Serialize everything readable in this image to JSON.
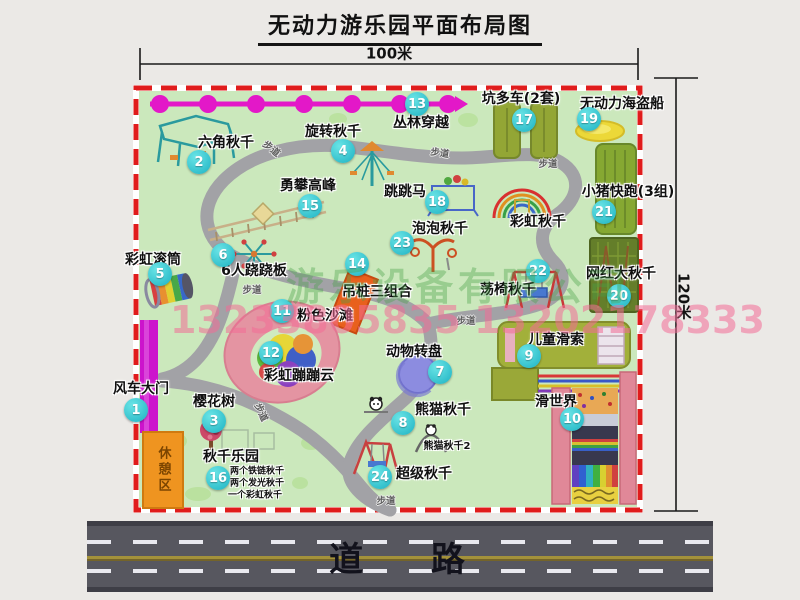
{
  "title": "无动力游乐园平面布局图",
  "dimensions": {
    "width_label": "100米",
    "height_label": "120米"
  },
  "road": {
    "label": "道 路"
  },
  "watermark": {
    "company": "游乐设备有限公司",
    "phone": "13233805835 13202178333"
  },
  "path_label": "步道",
  "colors": {
    "accent_badge": "#1db2c2",
    "border_red": "#e01c1c",
    "map_green": "#cbe8bc",
    "road_gray": "#57575f",
    "chain_magenta": "#e318c8",
    "rest_orange": "#ef9420"
  },
  "map": {
    "attractions": [
      {
        "num": "1",
        "name": "风车大门"
      },
      {
        "num": "2",
        "name": "六角秋千"
      },
      {
        "num": "3",
        "name": "樱花树"
      },
      {
        "num": "4",
        "name": "旋转秋千"
      },
      {
        "num": "5",
        "name": "彩虹滚筒"
      },
      {
        "num": "6",
        "name": "6人跷跷板"
      },
      {
        "num": "7",
        "name": "动物转盘"
      },
      {
        "num": "8",
        "name": "熊猫秋千"
      },
      {
        "num": "9",
        "name": "儿童滑索"
      },
      {
        "num": "10",
        "name": "滑世界"
      },
      {
        "num": "11",
        "name": "粉色沙滩"
      },
      {
        "num": "12",
        "name": "彩虹蹦蹦云"
      },
      {
        "num": "13",
        "name": "丛林穿越"
      },
      {
        "num": "14",
        "name": "吊桩三组合"
      },
      {
        "num": "15",
        "name": "勇攀高峰"
      },
      {
        "num": "16",
        "name": "秋千乐园"
      },
      {
        "num": "17",
        "name": "坑多车(2套)"
      },
      {
        "num": "18",
        "name": "跳跳马"
      },
      {
        "num": "19",
        "name": "无动力海盗船"
      },
      {
        "num": "20",
        "name": "网红大秋千"
      },
      {
        "num": "21",
        "name": "小猪快跑(3组)"
      },
      {
        "num": "22",
        "name": "荡椅秋千"
      },
      {
        "num": "23",
        "name": "泡泡秋千"
      },
      {
        "num": "24",
        "name": "超级秋千"
      }
    ],
    "extra": {
      "rainbow_swing": "彩虹秋千",
      "panda_swing_2": "熊猫秋千2",
      "rest_area": "休憩区"
    },
    "notes": [
      "两个铁链秋千",
      "两个发光秋千",
      "一个彩虹秋千"
    ]
  }
}
